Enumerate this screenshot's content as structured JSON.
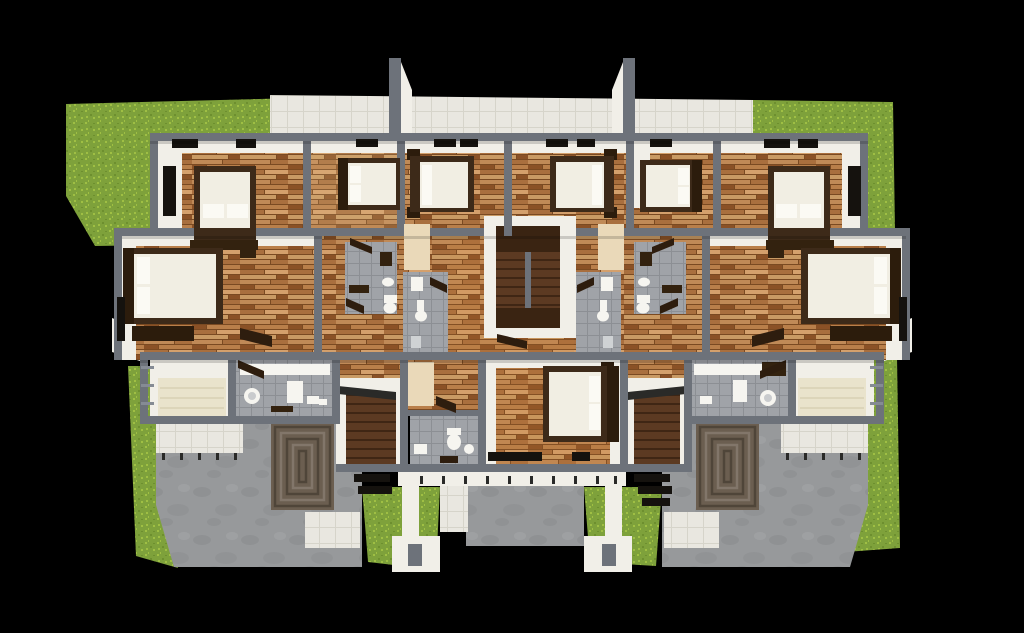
{
  "scene": {
    "type": "3d-architectural-floor-plan-render",
    "view": "top-down-aerial",
    "background": "#000000"
  },
  "palette": {
    "wall": "#6d727a",
    "wall-light": "#858b94",
    "white-wall": "#f1efe8",
    "walkway-tile": "#e9e7e0",
    "tile-line": "#d6d4ca",
    "bath-tile": "#a0a3a8",
    "bath-tile-line": "#8c8f94",
    "wood-1": "#c08a57",
    "wood-2": "#a96f3e",
    "wood-3": "#8a5126",
    "wood-4": "#d4a06c",
    "wood-5": "#b97f4a",
    "wood-6": "#c99a64",
    "wood-gap": "#7a4a22",
    "grass": "#7ea13b",
    "grass-light": "#9fbf44",
    "grass-dark": "#6d8f2f",
    "concrete": "#97999b",
    "concrete-dark": "#85878a",
    "brick": "#6b5e50",
    "brick-dark": "#4f4539",
    "brick-light": "#82766a",
    "stair-wood": "#5c3a22",
    "stair-line": "#3f2614",
    "stair-landing": "#3a2412",
    "bed-frame": "#3d2a19",
    "bed-frame-dark": "#2c1c0c",
    "mattress": "#f1eee3",
    "pillow": "#fbfaf4",
    "cream": "#ead9b9",
    "daybed": "#e9e3cc",
    "fixture": "#f6f5f0",
    "dark-furniture": "#33220f",
    "door-leaf": "#2e1d0e",
    "window": "#15120e",
    "post": "#2a2a28"
  },
  "inventory": {
    "bedrooms": 9,
    "beds": 9,
    "bathrooms": 5,
    "staircases": 3,
    "lawn_patches": 5,
    "patios": 2,
    "objects": [
      "bed",
      "pillow",
      "nightstand",
      "dresser",
      "wardrobe",
      "day-bed",
      "toilet",
      "sink",
      "vanity-counter",
      "shower",
      "washer",
      "stairs",
      "railing",
      "window",
      "skylight",
      "door-leaf",
      "lawn",
      "brick-spiral-paving",
      "concrete-patio",
      "white-parapet",
      "rear-walkway"
    ]
  }
}
